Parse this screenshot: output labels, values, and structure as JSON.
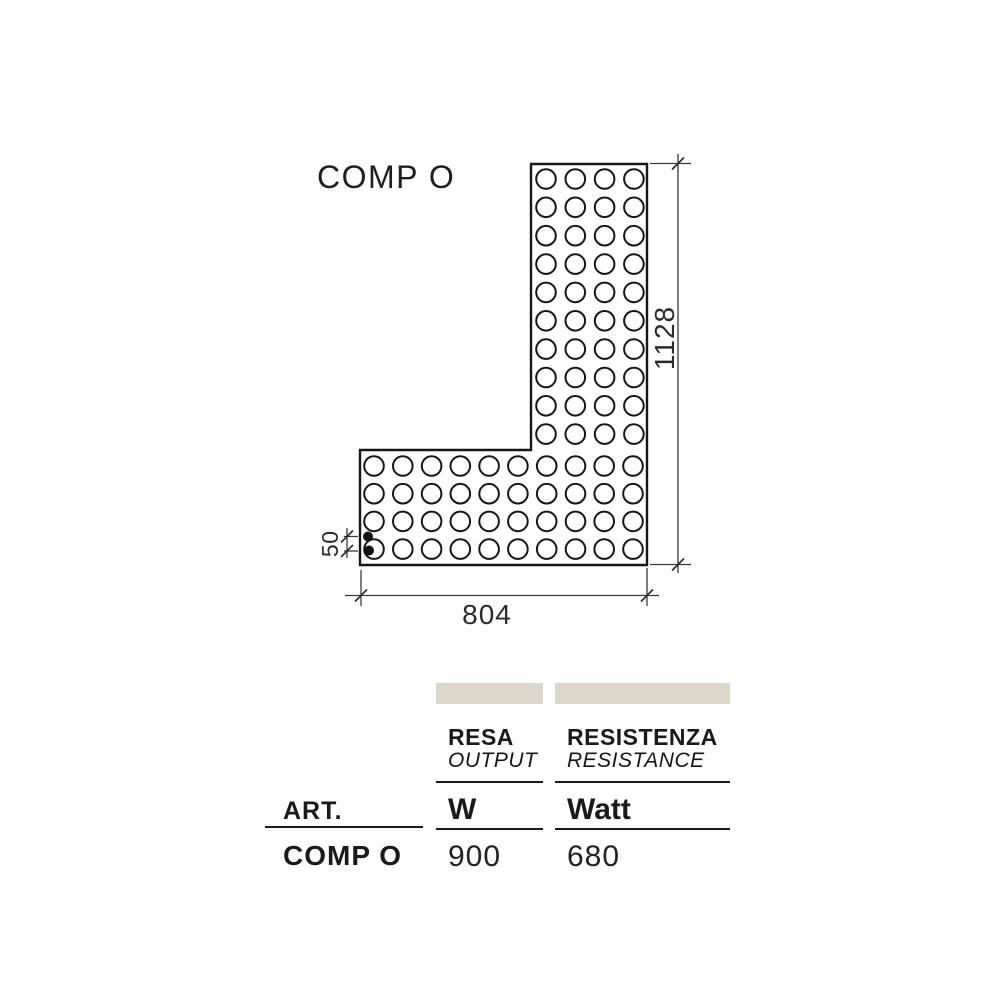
{
  "title": "COMP O",
  "drawing": {
    "labels": {
      "height": "1128",
      "width": "804",
      "spacing": "50"
    },
    "circle_radius": 9.8,
    "grids": [
      {
        "x0": 546,
        "dx": 29.3,
        "cols": 4,
        "y0": 179,
        "dy": 28.35,
        "rows": 10
      },
      {
        "x0": 374,
        "dx": 28.78,
        "cols": 10,
        "y0": 466,
        "dy": 27.7,
        "rows": 4
      }
    ],
    "connection_dots": [
      {
        "x": 368,
        "y": 536.5,
        "r": 5
      },
      {
        "x": 369,
        "y": 550.5,
        "r": 5
      }
    ]
  },
  "table": {
    "art_label": "ART.",
    "columns": [
      {
        "name_it": "RESA",
        "name_en": "OUTPUT",
        "unit": "W"
      },
      {
        "name_it": "RESISTENZA",
        "name_en": "RESISTANCE",
        "unit": "Watt"
      }
    ],
    "rows": [
      {
        "art": "COMP O",
        "output_w": "900",
        "resistance_watt": "680"
      }
    ],
    "header_bar_color": "#dbd8cb"
  }
}
